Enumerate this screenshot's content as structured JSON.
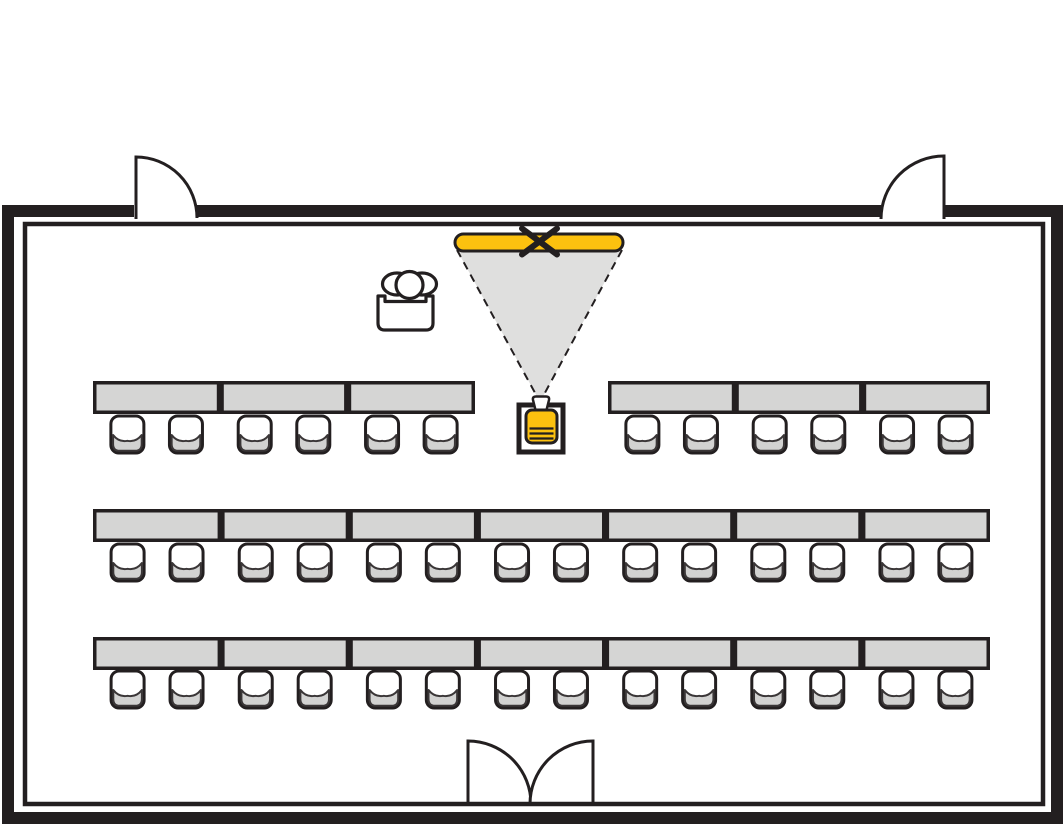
{
  "diagram": {
    "type": "floor-plan",
    "subject": "meeting-room-classroom-seating",
    "totals": {
      "tables": 20,
      "chairs": 40,
      "doors": 3,
      "screens": 1,
      "projectors": 1,
      "lecterns": 1
    }
  },
  "canvas": {
    "width": 1063,
    "height": 825
  },
  "colors": {
    "ink": "#231F20",
    "background": "#FFFFFF",
    "accent_yellow": "#FCC10F",
    "cone_gray": "#DFDFDE",
    "table_gray": "#D5D5D4",
    "seat_gray": "#D2D2D1",
    "seat_edge": "#3A3637"
  },
  "walls": {
    "outer": {
      "x": 8,
      "y": 211,
      "w": 1049,
      "h": 607,
      "stroke_w": 12
    },
    "inner": {
      "x": 25,
      "y": 224,
      "w": 1018,
      "h": 580,
      "stroke_w": 4.5
    },
    "gaps": [
      {
        "name": "door-gap-top-left",
        "x": 134,
        "y": 203,
        "w": 62,
        "h": 16
      },
      {
        "name": "door-gap-top-right",
        "x": 881,
        "y": 203,
        "w": 63,
        "h": 16
      }
    ]
  },
  "doors": [
    {
      "name": "door-top-left",
      "path": "M 136 219 L 136 157 A 61 61 0 0 1 197 218"
    },
    {
      "name": "door-top-right",
      "path": "M 944 219 L 944 156 A 63 63 0 0 0 881 219"
    },
    {
      "name": "door-bottom-left-leaf",
      "path": "M 468 804 L 468 741 A 63 63 0 0 1 531 804"
    },
    {
      "name": "door-bottom-right-leaf",
      "path": "M 593 804 L 593 741 A 63 63 0 0 0 530 804"
    }
  ],
  "screen": {
    "x": 455,
    "y": 234,
    "w": 168,
    "h": 17,
    "r": 8.5,
    "stroke_w": 3,
    "marker": {
      "cx": 539.5,
      "cy": 241.5,
      "arm_x": 17.5,
      "arm_y": 13,
      "stroke_w": 6
    }
  },
  "cone": {
    "left_x": 457,
    "right_x": 622,
    "top_y": 250,
    "apex_x": 540,
    "apex_y": 402,
    "dash": "8 6",
    "edge_w": 2
  },
  "projector": {
    "stand": {
      "x": 519,
      "y": 405,
      "w": 44,
      "h": 47,
      "stroke_w": 5
    },
    "lens_path": "M 535.5 410 L 533 400 Q 532.3 396.5 536 396.5 L 546 396.5 Q 549.7 396.5 549 400 L 546.5 410",
    "body": {
      "x": 526,
      "y": 410,
      "w": 31,
      "h": 33,
      "r": 6,
      "stroke_w": 3
    },
    "vents": {
      "x1": 529.5,
      "x2": 553.5,
      "ys": [
        428.5,
        433.5,
        438.5
      ],
      "stroke_w": 2.2
    }
  },
  "lectern": {
    "shoulders": [
      {
        "cx": 397,
        "cy": 284,
        "rx": 14.5,
        "ry": 11
      },
      {
        "cx": 422,
        "cy": 284,
        "rx": 14.5,
        "ry": 11
      }
    ],
    "head": {
      "cx": 409.5,
      "cy": 285,
      "r": 13.5
    },
    "desk_path": "M 378 296 L 378 323 Q 378 330 385 330 L 426 330 Q 433 330 433 323 L 433 296 L 426 296 L 426 301.5 L 385 301.5 L 385 296 Z",
    "stroke_w": 3.2
  },
  "table_rows": [
    {
      "name": "row-front-left",
      "x": 93,
      "y": 381,
      "count": 3,
      "end_x": 475,
      "h": 33,
      "chair_y": 416
    },
    {
      "name": "row-front-right",
      "x": 608,
      "y": 381,
      "count": 3,
      "end_x": 990,
      "h": 33,
      "chair_y": 416
    },
    {
      "name": "row-middle",
      "x": 93,
      "y": 509,
      "count": 7,
      "end_x": 990,
      "h": 33,
      "chair_y": 544
    },
    {
      "name": "row-back",
      "x": 93,
      "y": 637,
      "count": 7,
      "end_x": 990,
      "h": 33,
      "chair_y": 671
    }
  ],
  "table_border_w": 3.5,
  "chair": {
    "w": 33,
    "h": 37,
    "r": 8,
    "border_w": 3,
    "centers": [
      0.27,
      0.73
    ]
  }
}
